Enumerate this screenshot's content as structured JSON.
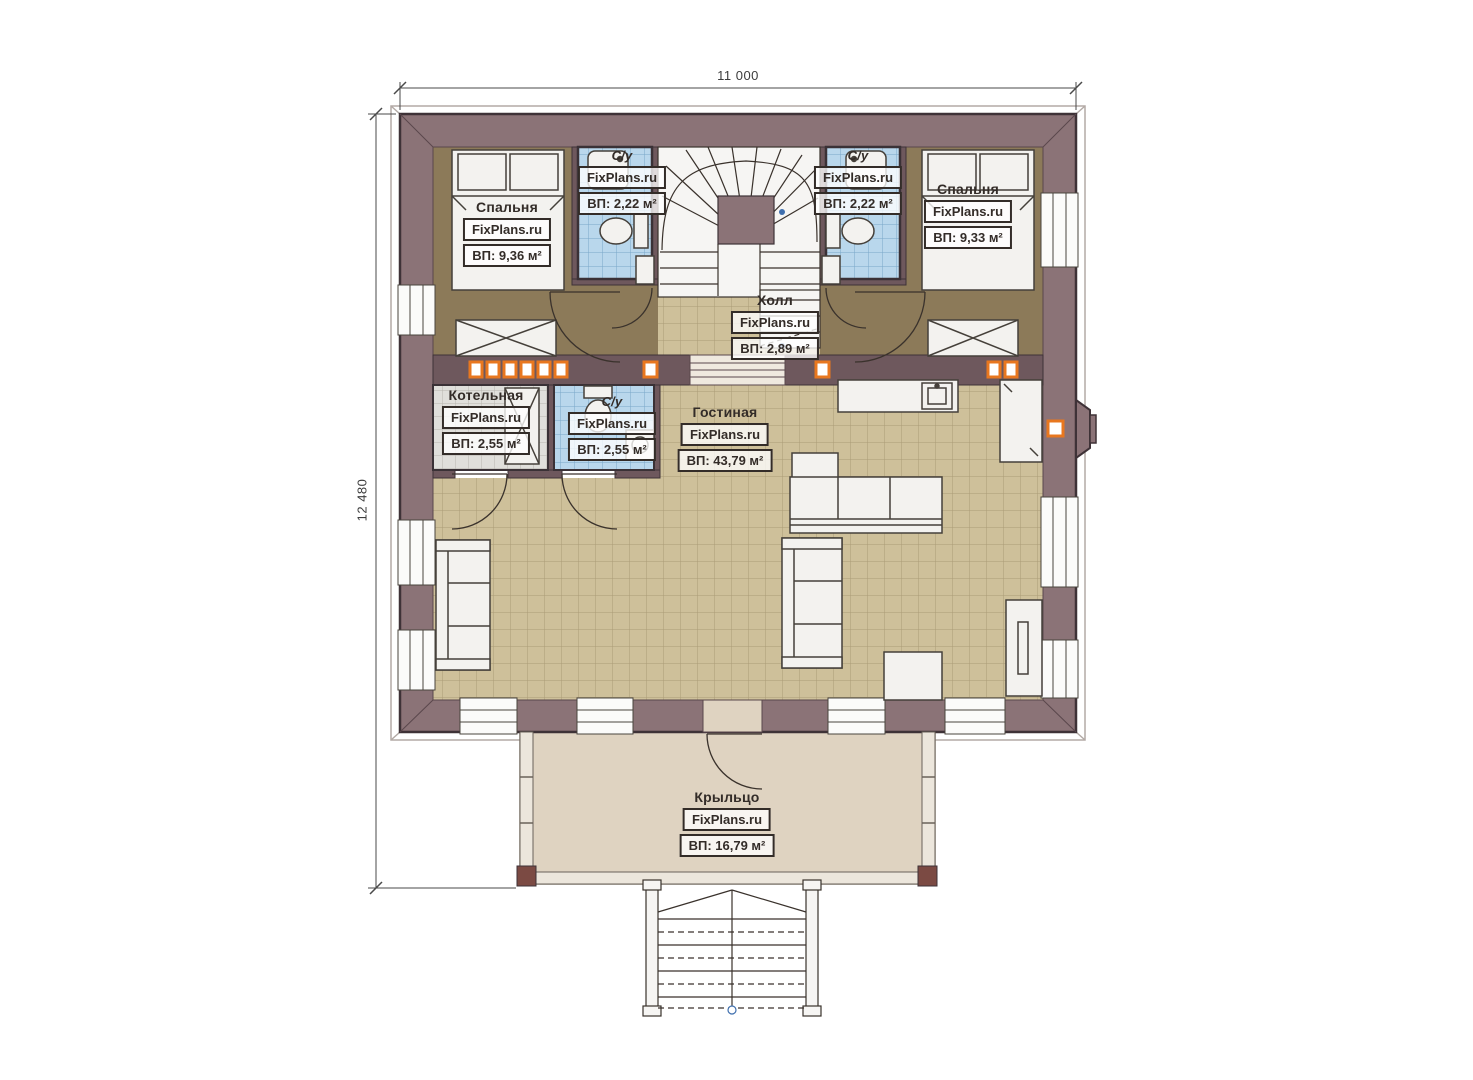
{
  "plan": {
    "type": "floor-plan",
    "dimensions": {
      "width_label": "11 000",
      "height_label": "12 480"
    },
    "rooms": [
      {
        "id": "bedroom-left",
        "name": "Спальня",
        "brand": "FixPlans.ru",
        "area": "ВП: 9,36 м²"
      },
      {
        "id": "bathroom-left",
        "name": "С/у",
        "brand": "FixPlans.ru",
        "area": "ВП: 2,22 м²"
      },
      {
        "id": "bathroom-right",
        "name": "С/у",
        "brand": "FixPlans.ru",
        "area": "ВП: 2,22 м²"
      },
      {
        "id": "bedroom-right",
        "name": "Спальня",
        "brand": "FixPlans.ru",
        "area": "ВП: 9,33 м²"
      },
      {
        "id": "hall",
        "name": "Холл",
        "brand": "FixPlans.ru",
        "area": "ВП: 2,89 м²"
      },
      {
        "id": "boiler",
        "name": "Котельная",
        "brand": "FixPlans.ru",
        "area": "ВП: 2,55 м²"
      },
      {
        "id": "bathroom-mid",
        "name": "С/у",
        "brand": "FixPlans.ru",
        "area": "ВП: 2,55 м²"
      },
      {
        "id": "living",
        "name": "Гостиная",
        "brand": "FixPlans.ru",
        "area": "ВП: 43,79 м²"
      },
      {
        "id": "porch",
        "name": "Крыльцо",
        "brand": "FixPlans.ru",
        "area": "ВП: 16,79 м²"
      }
    ],
    "colors": {
      "wall": "#8b7377",
      "wall_outline": "#3e3237",
      "interior_wall": "#6e585d",
      "bedroom_floor": "#8c7a59",
      "tile_tan": "#cec09a",
      "tile_blue": "#b9d7ec",
      "tile_gray": "#e0dfdb",
      "porch_floor": "#dfd3c1",
      "accent_orange": "#e8771f",
      "corner_block": "#7b4a43",
      "furniture": "#f3f2ef"
    }
  }
}
